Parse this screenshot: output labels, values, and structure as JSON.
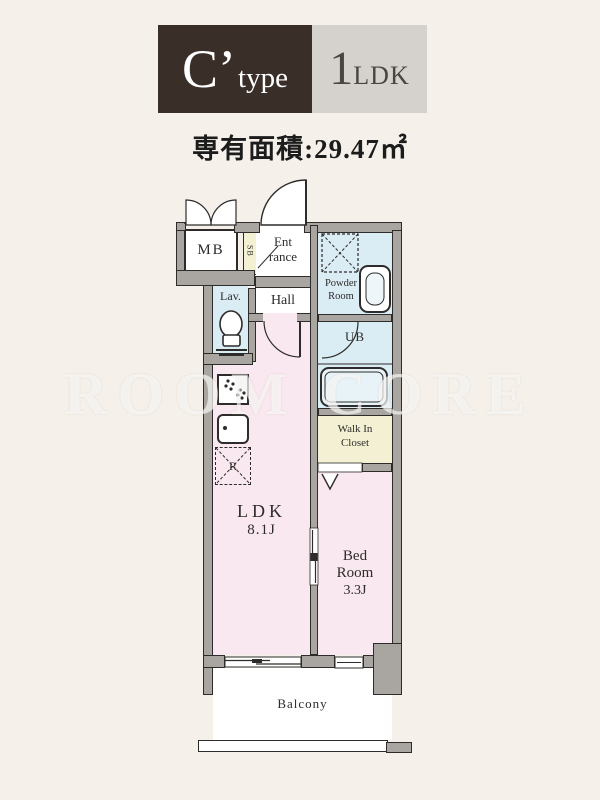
{
  "header": {
    "type_main": "C’",
    "type_sub": "type",
    "plan_main": "1",
    "plan_sub": "LDK"
  },
  "area_text": "専有面積:29.47㎡",
  "watermark": "ROOM CORE",
  "rooms": {
    "mb": "MB",
    "sb": "SB",
    "entrance_line1": "Ent",
    "entrance_line2": "rance",
    "lav": "Lav.",
    "hall": "Hall",
    "powder_line1": "Powder",
    "powder_line2": "Room",
    "ub": "UB",
    "wic_line1": "Walk In",
    "wic_line2": "Closet",
    "ldk_name": "LDK",
    "ldk_size": "8.1J",
    "bed_line1": "Bed",
    "bed_line2": "Room",
    "bed_size": "3.3J",
    "balcony": "Balcony",
    "fridge": "R"
  },
  "colors": {
    "background": "#f5f1ea",
    "header_dark": "#3a2e29",
    "header_gray": "#d5d2ce",
    "room_pink": "#f9e8ef",
    "room_blue": "#daecf4",
    "room_cream": "#f4f0d4",
    "wall_gray": "#a9a6a2",
    "line_dark": "#2e2c2a"
  }
}
